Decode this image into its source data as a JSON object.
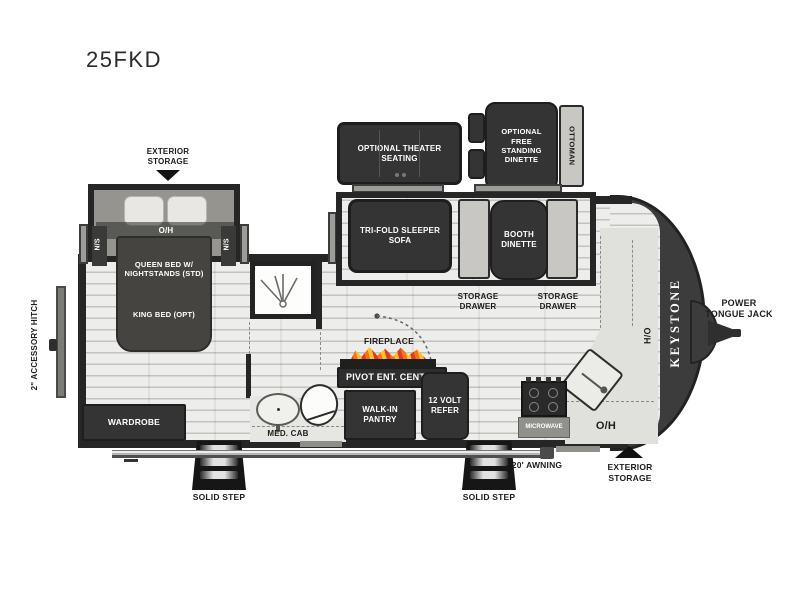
{
  "title": "25FKD",
  "top": {
    "exterior_storage": "EXTERIOR STORAGE",
    "theater": "OPTIONAL THEATER SEATING",
    "free_dinette": "OPTIONAL FREE STANDING DINETTE",
    "ottoman": "OTTOMAN"
  },
  "living": {
    "sofa": "TRI-FOLD SLEEPER SOFA",
    "booth": "BOOTH DINETTE",
    "drawer1": "STORAGE DRAWER",
    "drawer2": "STORAGE DRAWER"
  },
  "bedroom": {
    "oh": "O/H",
    "ns_left": "N/S",
    "ns_right": "N/S",
    "queen": "QUEEN BED W/ NIGHTSTANDS (STD)",
    "king": "KING BED (OPT)",
    "wardrobe": "WARDROBE"
  },
  "bath": {
    "med_cab": "MED. CAB"
  },
  "center": {
    "fireplace": "FIREPLACE",
    "pivot": "PIVOT ENT. CENTER",
    "pantry": "WALK-IN PANTRY",
    "refer": "12 VOLT REFER"
  },
  "kitchen": {
    "microwave": "MICROWAVE",
    "oh": "O/H",
    "ho": "H/O"
  },
  "front": {
    "brand": "KEYSTONE",
    "power_tongue_jack": "POWER TONGUE JACK"
  },
  "left_side": {
    "accessory_hitch": "2\" ACCESSORY HITCH"
  },
  "bottom": {
    "step1": "SOLID STEP",
    "step2": "SOLID STEP",
    "awning": "20' AWNING",
    "exterior_storage": "EXTERIOR STORAGE"
  },
  "colors": {
    "wall": "#262626",
    "furniture_dark": "#343434",
    "floor": "#e3e3e0",
    "bench_light": "#c8c7c3",
    "counter": "#e0e0dc",
    "slide_interior": "#96948f",
    "flame_orange": "#f97316",
    "flame_red": "#e03b24",
    "flame_yellow": "#fbc22d",
    "text_dark": "#1d1d1d",
    "text_light": "#ffffff"
  }
}
